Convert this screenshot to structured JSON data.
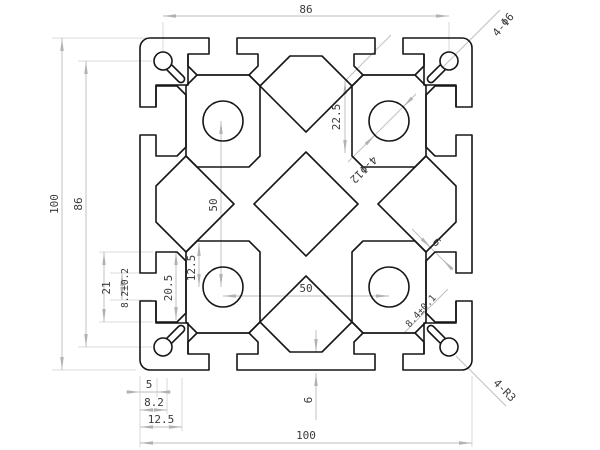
{
  "drawing": {
    "type": "technical-cad-cross-section",
    "part": "aluminium extrusion profile 100x100 with T-slots",
    "units": "mm",
    "line_colors": {
      "profile": "#161616",
      "dimension": "#bcbcbc",
      "text": "#3a3a3a"
    },
    "profile_features": {
      "outer_size": "100 x 100",
      "corner_holes": "4-Φ6 keyhole slots",
      "core_holes": "4-Φ12",
      "corner_radius": "4-R3",
      "slot_opening_left": "8.2±0.2",
      "slot_opening_right": "8.4±0.1"
    }
  },
  "dims": [
    {
      "id": "dim-top-86",
      "label": "86"
    },
    {
      "id": "dim-left-100",
      "label": "100"
    },
    {
      "id": "dim-left-86",
      "label": "86"
    },
    {
      "id": "note-corner-holes",
      "label": "4-Φ6"
    },
    {
      "id": "dim-22-5",
      "label": "22.5"
    },
    {
      "id": "note-core-holes",
      "label": "4-Φ12"
    },
    {
      "id": "dim-50-vertical",
      "label": "50"
    },
    {
      "id": "dim-50-horizontal",
      "label": "50"
    },
    {
      "id": "dim-12-5-vertical",
      "label": "12.5"
    },
    {
      "id": "dim-20-5",
      "label": "20.5"
    },
    {
      "id": "dim-21",
      "label": "21"
    },
    {
      "id": "dim-8-2-tol",
      "label": "8.2±0.2"
    },
    {
      "id": "dim-5",
      "label": "5"
    },
    {
      "id": "dim-8-2",
      "label": "8.2"
    },
    {
      "id": "dim-12-5-bottom",
      "label": "12.5"
    },
    {
      "id": "dim-100-bottom",
      "label": "100"
    },
    {
      "id": "dim-6-bottom-wall",
      "label": "6"
    },
    {
      "id": "dim-6-rib",
      "label": "6"
    },
    {
      "id": "dim-8-4-tol",
      "label": "8.4±0.1"
    },
    {
      "id": "note-corner-radius",
      "label": "4-R3"
    }
  ]
}
